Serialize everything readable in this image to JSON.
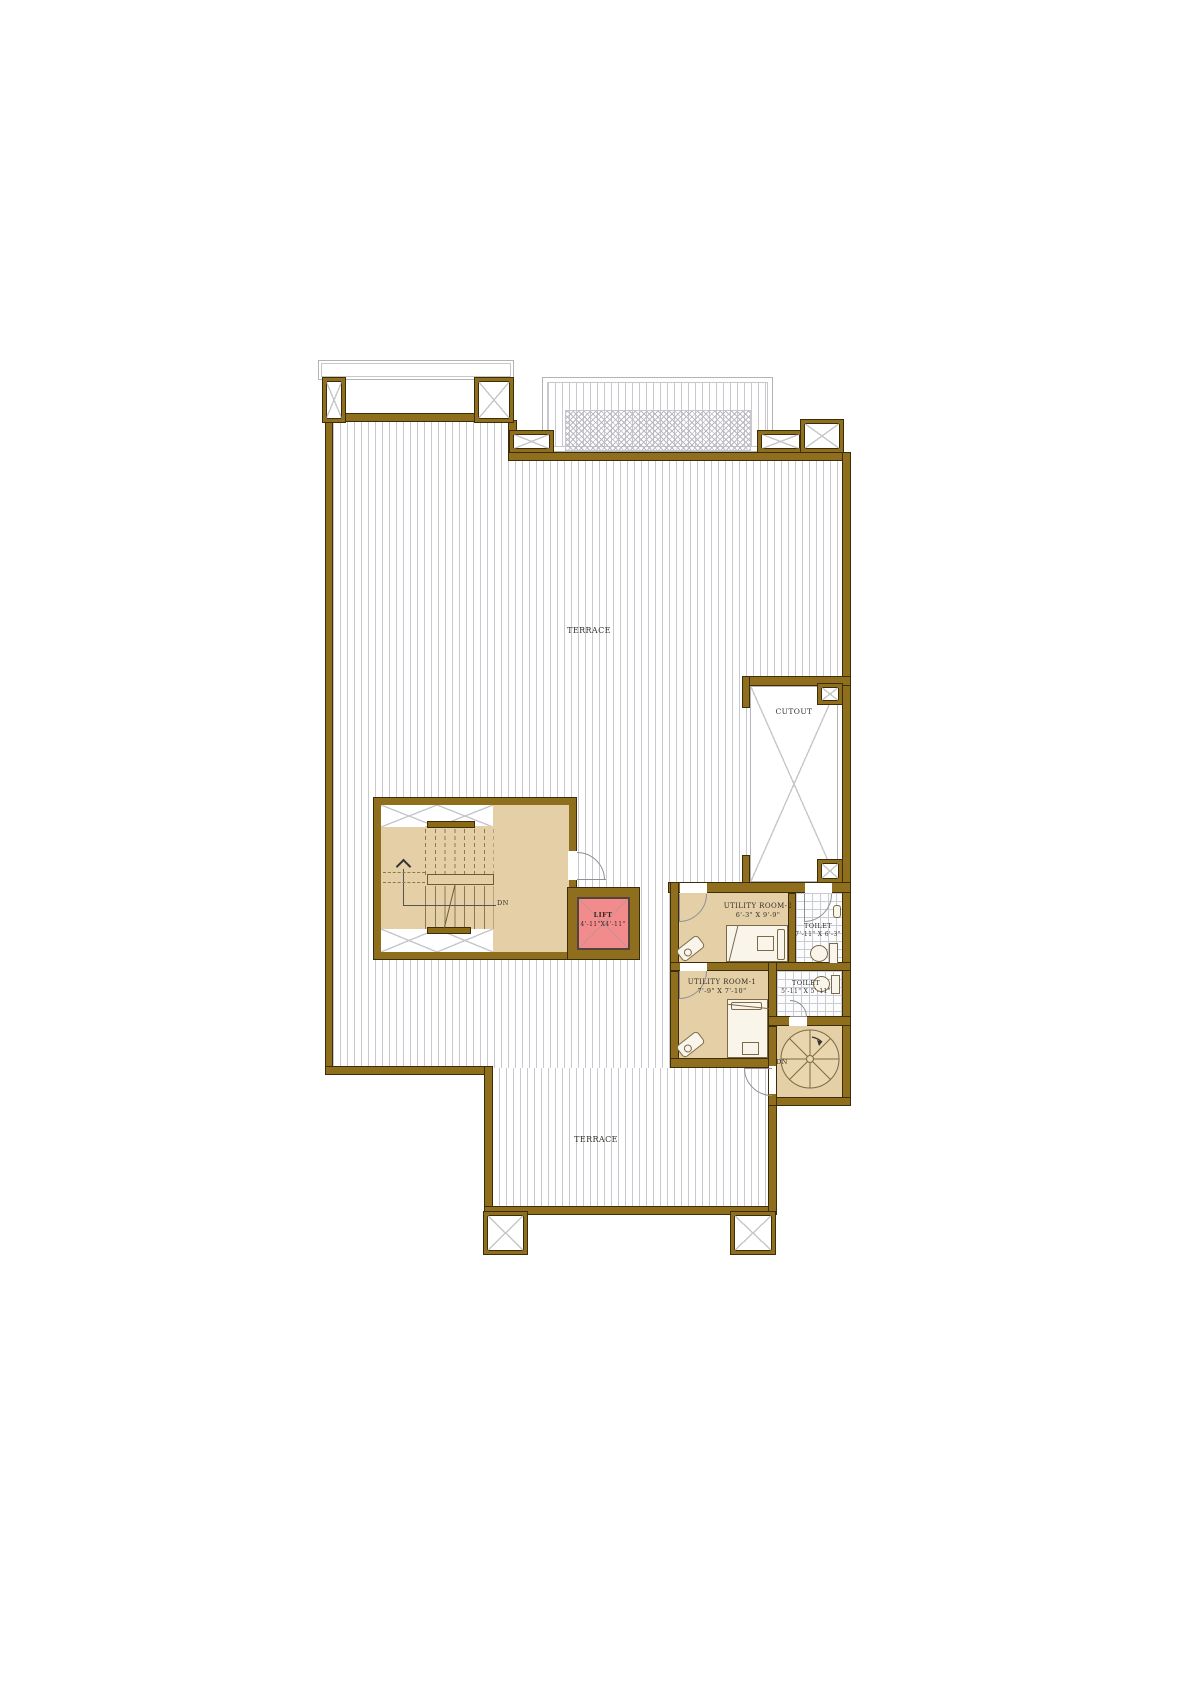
{
  "plan": {
    "colors": {
      "wall": "#8f6f1e",
      "wall_edge": "#3b2d08",
      "room_fill": "#e4cfa7",
      "lift_fill": "#f28b8b",
      "terrace_hatch": "#c8c8ce",
      "tile_hatch": "#c9ccd4",
      "label_ink": "#33302a"
    },
    "labels": {
      "terrace_top": "TERRACE",
      "terrace_bottom": "TERRACE",
      "cutout": "CUTOUT",
      "lift_name": "LIFT",
      "lift_dims": "4'-11\"X4'-11\"",
      "utility2_name": "UTILITY ROOM-2",
      "utility2_dims": "6'-3\" X 9'-9\"",
      "toilet1_name": "TOILET",
      "toilet1_dims": "7'-11\" X 6'-3\"",
      "utility1_name": "UTILITY ROOM-1",
      "utility1_dims": "7'-9\" X 7'-10\"",
      "toilet2_name": "TOILET",
      "toilet2_dims": "5'-11\" X 5'-11\"",
      "stair_down": "DN",
      "spiral_down": "DN"
    }
  }
}
